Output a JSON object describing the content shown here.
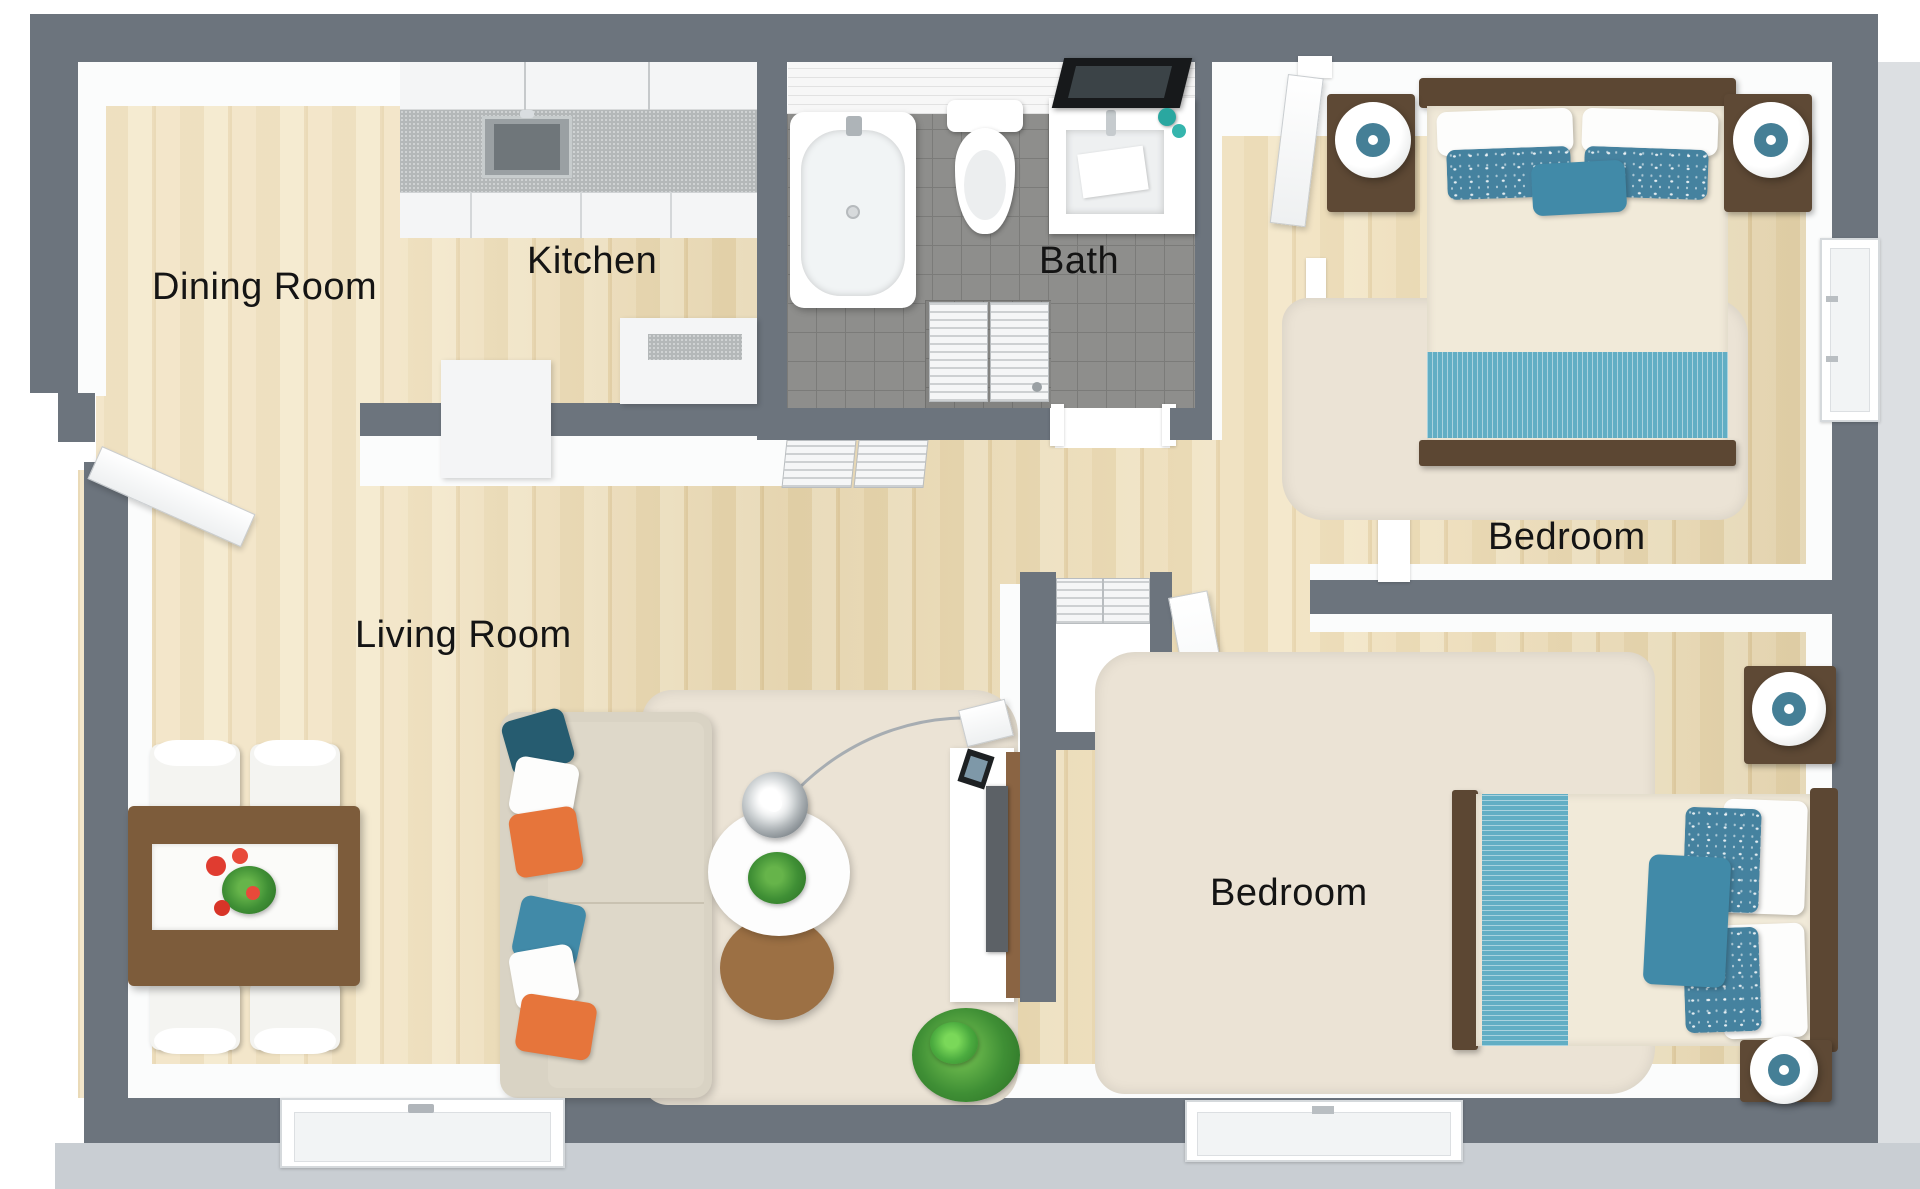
{
  "floorplan": {
    "title": "2 Bedroom Apartment Floor Plan",
    "rooms": [
      {
        "id": "dining-room",
        "label": "Dining Room"
      },
      {
        "id": "kitchen",
        "label": "Kitchen"
      },
      {
        "id": "bath",
        "label": "Bath"
      },
      {
        "id": "bedroom-top",
        "label": "Bedroom"
      },
      {
        "id": "living-room",
        "label": "Living Room"
      },
      {
        "id": "bedroom-bottom",
        "label": "Bedroom"
      }
    ],
    "colors": {
      "wall": "#6c747d",
      "wood_floor": "#ead7ae",
      "bath_tile": "#8e8e8c",
      "rug": "#ebe3d5",
      "accent_teal": "#45829f",
      "accent_dark_teal": "#265c70",
      "accent_blue": "#418aa8",
      "accent_orange": "#e6753b",
      "bed_frame_brown": "#5c4733",
      "table_brown": "#7d5c3b"
    }
  }
}
